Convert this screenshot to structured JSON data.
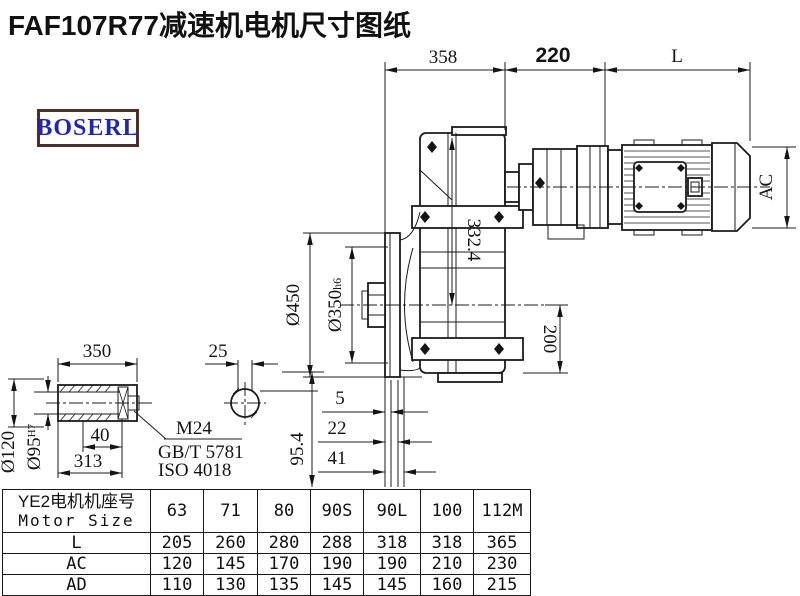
{
  "title": "FAF107R77减速机电机尺寸图纸",
  "logo": {
    "text": "BOSERL"
  },
  "colors": {
    "logo_border": "#4a2f2b",
    "logo_text": "#2224b5",
    "line": "#1b1b1b"
  },
  "drawing": {
    "dimensions": {
      "d358": "358",
      "d220": "220",
      "dL": "L",
      "dAC": "AC",
      "d332": "332.4",
      "d200": "200",
      "d450": "Ø450",
      "d350": "Ø350",
      "d350tol": "h6",
      "d5": "5",
      "d22": "22",
      "d41": "41",
      "dshaft350": "350",
      "d25": "25",
      "d954": "95.4",
      "d120": "Ø120",
      "d95": "Ø95",
      "d95tol": "H7",
      "d40": "40",
      "d313": "313"
    },
    "labels": {
      "bolt": "M24",
      "std_gb": "GB/T 5781",
      "std_iso": "ISO 4018"
    }
  },
  "table": {
    "header_cn": "YE2电机机座号",
    "header_en": "Motor Size",
    "columns": [
      "63",
      "71",
      "80",
      "90S",
      "90L",
      "100",
      "112M"
    ],
    "rows": [
      {
        "label": "L",
        "values": [
          "205",
          "260",
          "280",
          "288",
          "318",
          "318",
          "365"
        ]
      },
      {
        "label": "AC",
        "values": [
          "120",
          "145",
          "170",
          "190",
          "190",
          "210",
          "230"
        ]
      },
      {
        "label": "AD",
        "values": [
          "110",
          "130",
          "135",
          "145",
          "145",
          "160",
          "215"
        ]
      }
    ]
  }
}
